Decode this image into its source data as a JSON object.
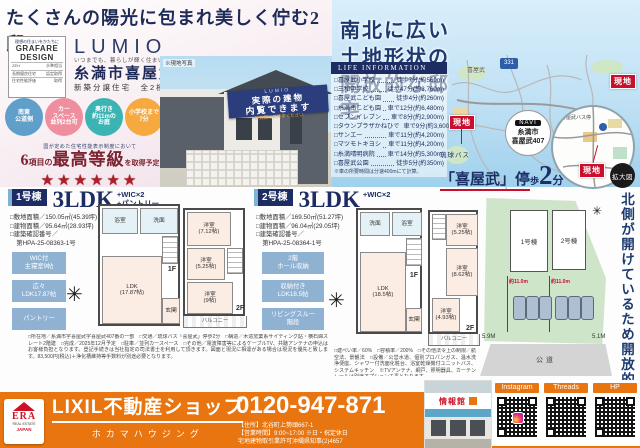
{
  "colors": {
    "navy": "#1d2c63",
    "red": "#c8102e",
    "orange": "#e8750f",
    "sky": "#bfe0f4",
    "feature_blue": "#8fb2d2",
    "badge_blue": "#5f9fca",
    "badge_pink": "#ef8e9e",
    "badge_teal": "#3cb4b4",
    "badge_orange": "#f5a93f",
    "lot_green": "#cfe5ca"
  },
  "icons": {
    "compass": "✳",
    "star": "★"
  },
  "header": {
    "main_title": "たくさんの陽光に包まれ美しく佇む2邸",
    "right_title_l1": "南北に広い",
    "right_title_l2": "土地形状の",
    "right_title_l3": "開放的な邸宅"
  },
  "brand": {
    "design_top": "理想の住まいをかたちに",
    "design_name1": "GRAFARE",
    "design_name2": "DESIGN",
    "rows": [
      {
        "k": "ZEH",
        "v": "水準相当"
      },
      {
        "k": "長期優良住宅",
        "v": "認定取得"
      },
      {
        "k": "住宅性能評価",
        "v": "取得"
      }
    ],
    "logo": "LUMIO",
    "tagline": "いつまでも、暮らしが輝く住まい",
    "location": "糸満市喜屋武",
    "subtitle": "新築分譲住宅　全2棟"
  },
  "badges": [
    {
      "l1": "南東",
      "l2": "公道側",
      "l3": "",
      "color": "#5f9fca"
    },
    {
      "l1": "カー",
      "l2": "スペース",
      "l3": "並列2台可",
      "color": "#ef8e9e"
    },
    {
      "l1": "奥行き",
      "l2": "約11mの",
      "l3": "お庭",
      "color": "#3cb4b4"
    },
    {
      "l1": "小学校まで",
      "l2": "7分",
      "l3": "",
      "color": "#f5a93f"
    }
  ],
  "grade": {
    "note": "国が定めた住宅性能表示制度において",
    "num": "6",
    "pre": "項目の",
    "main": "最高等級",
    "post1": "を取得",
    "post2": "予定",
    "star": "★"
  },
  "photo": {
    "label": "※現地写真",
    "banner_logo": "LUMIO",
    "banner_l1": "実際の建物",
    "banner_l2": "内覧できます",
    "banner_sub": "お気軽にご見学ください"
  },
  "life_info": {
    "header": "LIFE INFORMATION",
    "items": [
      {
        "name": "□喜屋武小学校",
        "value": "徒歩7分(約560m)"
      },
      {
        "name": "□三和中学校",
        "value": "徒歩47分(約3,760m)"
      },
      {
        "name": "□喜屋武こども園",
        "value": "徒歩4分(約260m)"
      },
      {
        "name": "□糸満南こども園",
        "value": "車で12分(約6,480m)"
      },
      {
        "name": "□セブンイレブン",
        "value": "車で8分(約2,900m)"
      },
      {
        "name": "□タウンプラザかねひで",
        "value": "車で9分(約3,600m)"
      },
      {
        "name": "□サンエー",
        "value": "車で11分(約4,200m)"
      },
      {
        "name": "□マツモトキヨシ",
        "value": "車で11分(約4,200m)"
      },
      {
        "name": "□糸満晴明病院",
        "value": "車で14分(約5,300m)"
      },
      {
        "name": "□喜屋武公園",
        "value": "徒歩5分(約350m)"
      }
    ],
    "note": "※車の所要時間は分速400mにて計算。"
  },
  "map": {
    "site_label": "現地",
    "navi": "NAVI",
    "navi_l1": "糸満市",
    "navi_l2": "喜屋武407",
    "route": "331",
    "town": "喜屋武",
    "bus_stop_small": "喜屋武バス停",
    "magnify": "拡大図",
    "bus_company": "琉球バス",
    "bus_stop": "「喜屋武」停",
    "bus_walk": "歩",
    "bus_num": "2",
    "bus_min": "分"
  },
  "site_plan": {
    "lot1": "1号棟",
    "lot2": "2号棟",
    "dim": "約11.0m",
    "road": "公道",
    "left_w": "5.9M",
    "right_w": "5.1M"
  },
  "side_note": "北側が開けているため開放的",
  "unit1": {
    "tab": "1号棟",
    "ldk": "3LDK",
    "suffix1": "+WIC×2",
    "suffix2": "+パントリー",
    "spec1": "□敷地面積／150.05㎡(45.39坪)",
    "spec2": "□建物面積／95.64㎡(28.93坪)",
    "spec3": "□建築確認番号／",
    "spec3b": "　第HPA-25-08363-1号",
    "feat1a": "WIC付",
    "feat1b": "主寝室9帖",
    "feat2a": "広々",
    "feat2b": "LDK17.87帖",
    "feat3a": "パントリー",
    "f1": {
      "bath": "浴室",
      "wash": "洗面",
      "ldk": "LDK",
      "ldk_size": "(17.87帖)",
      "entry": "玄関",
      "label": "1F"
    },
    "f2": {
      "r1": "洋室",
      "r1s": "(7.12帖)",
      "r2": "洋室",
      "r2s": "(5.25帖)",
      "r3": "洋室",
      "r3s": "(9帖)",
      "balcony": "バルコニー",
      "label": "2F"
    }
  },
  "unit2": {
    "tab": "2号棟",
    "ldk": "3LDK",
    "suffix1": "+WIC×2",
    "spec1": "□敷地面積／169.50㎡(51.27坪)",
    "spec2": "□建物面積／96.04㎡(29.05坪)",
    "spec3": "□建築確認番号／",
    "spec3b": "　第HPA-25-08364-1号",
    "feat1a": "2階",
    "feat1b": "ホール収納",
    "feat2a": "収納付き",
    "feat2b": "LDK18.5帖",
    "feat3a": "リビングスルー",
    "feat3b": "階段",
    "f1": {
      "wash": "洗面",
      "bath": "浴室",
      "ldk": "LDK",
      "ldk_size": "(18.5帖)",
      "entry": "玄関",
      "label": "1F"
    },
    "f2": {
      "r1": "洋室",
      "r1s": "(5.25帖)",
      "r2": "洋室",
      "r2s": "(8.62帖)",
      "r3": "洋室",
      "r3s": "(4.93帖)",
      "balcony": "バルコニー",
      "label": "2F"
    }
  },
  "fine_print": {
    "left": "□所在地／糸満市字喜屋武字喜屋武407番の一部　□交通／琉球バス「喜屋武」停歩2分　□構造／木造窯業系サイディング貼・横石綿スレート2階建　□完成／2025年12月予定　□駐車／並列カースペース　□その他／電波障害等によるケーブルTV、共聴アンテナの申込はお客様負担となります。登記手続きは当社指定の司法書士を利用して頂きます。図面と現況に相違がある場合は現況を優先と致します。83,500円(税込)＋浄化槽維持等手数料が別途必要となります。",
    "right": "□建ぺい率／60%　□容積率／200%　□その他法令上の制限／航空法、景観法　□設備／公営水道、個別プロパンガス、温水洗浄便座、シャワー付洗面化粧台、浴室乾燥機付ユニットバス、システムキッチン　※TVアンテナ、網戸、照明器具、カーテンレールは別途オプション工事となります。"
  },
  "footer": {
    "era_name": "ERA",
    "era_sub": "REAL ESTATE",
    "era_jp": "JAPAN",
    "shop": "LIXIL不動産ショップ",
    "company": "ホカマハウジング",
    "phone": "0120-947-871",
    "address": "【住所】北谷町上勢頭667-1",
    "hours": "【営業時間】9:00~17:00 ※日・祝定休日",
    "license": "宅地建物取引業許可沖縄県知事(2)4657",
    "shop_sign": "情報館",
    "qr1": "Instagram",
    "qr2": "Threads",
    "qr3": "HP"
  }
}
